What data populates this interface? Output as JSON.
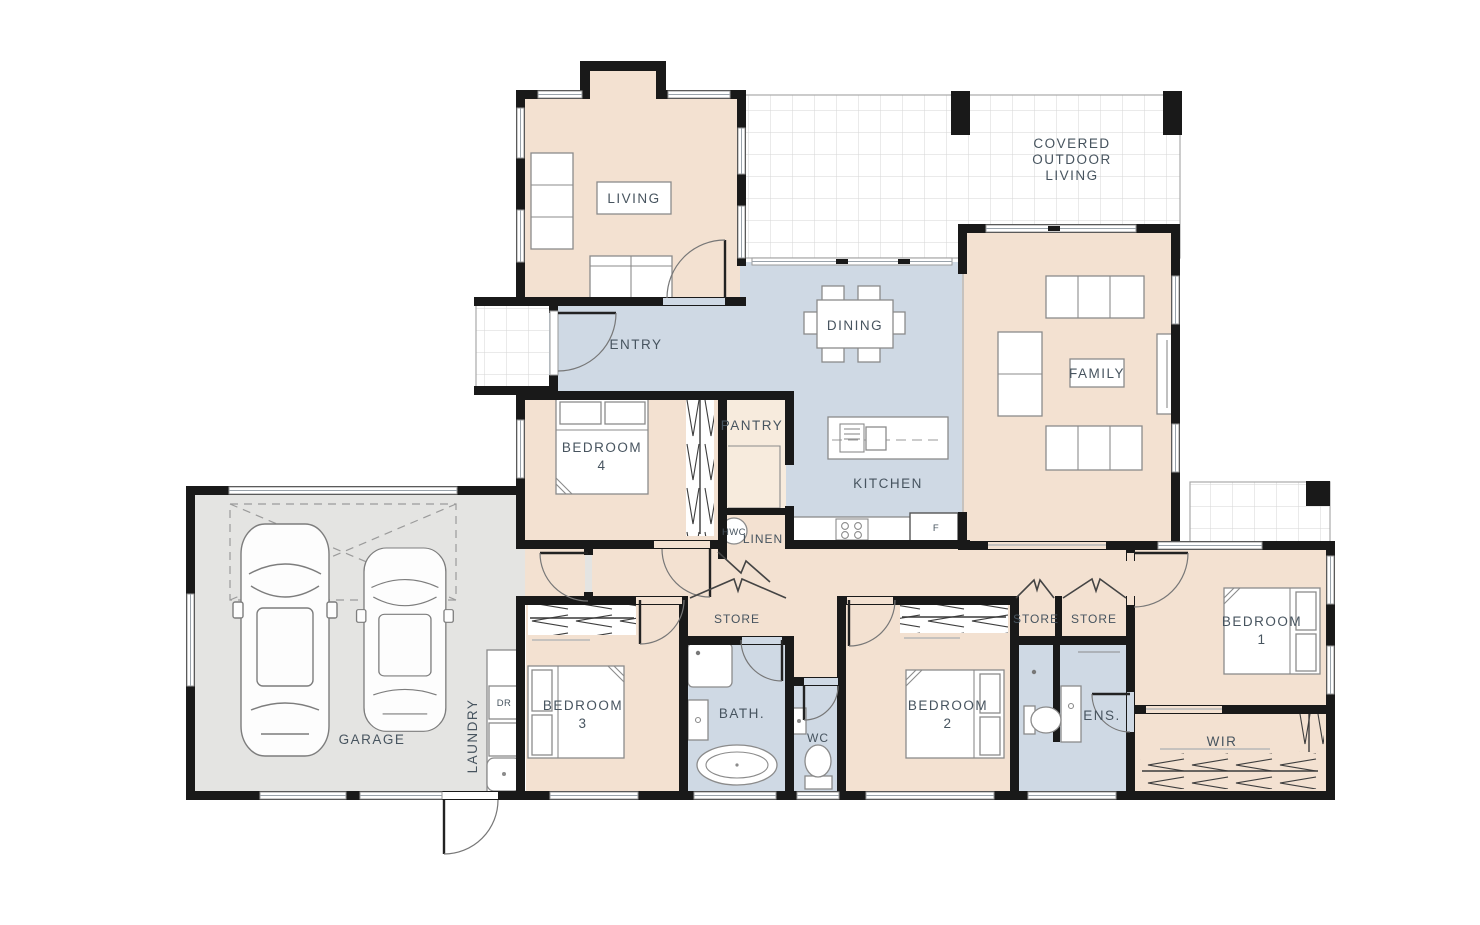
{
  "meta": {
    "type": "architectural-floor-plan",
    "storeys": "single"
  },
  "colors": {
    "room_fill": "#f3e1d1",
    "wet_area_fill": "#cfd9e4",
    "garage_fill": "#e4e4e2",
    "wall": "#191919",
    "label": "#47545f",
    "tile_line": "#d6d6d6"
  },
  "rooms": {
    "living": "LIVING",
    "covered_outdoor_living": [
      "COVERED",
      "OUTDOOR",
      "LIVING"
    ],
    "entry": "ENTRY",
    "dining": "DINING",
    "family": "FAMILY",
    "bedroom4": [
      "BEDROOM",
      "4"
    ],
    "pantry": "PANTRY",
    "kitchen": "KITCHEN",
    "hwc": "HWC",
    "linen": "LINEN",
    "garage": "GARAGE",
    "laundry": "LAUNDRY",
    "store_hall": "STORE",
    "bedroom3": [
      "BEDROOM",
      "3"
    ],
    "bath": "BATH.",
    "wc": "WC",
    "bedroom2": [
      "BEDROOM",
      "2"
    ],
    "store_a": "STORE",
    "store_b": "STORE",
    "ensuite": "ENS.",
    "bedroom1": [
      "BEDROOM",
      "1"
    ],
    "wir": "WIR"
  },
  "appliances": {
    "dryer": "DR",
    "fridge": "F"
  }
}
